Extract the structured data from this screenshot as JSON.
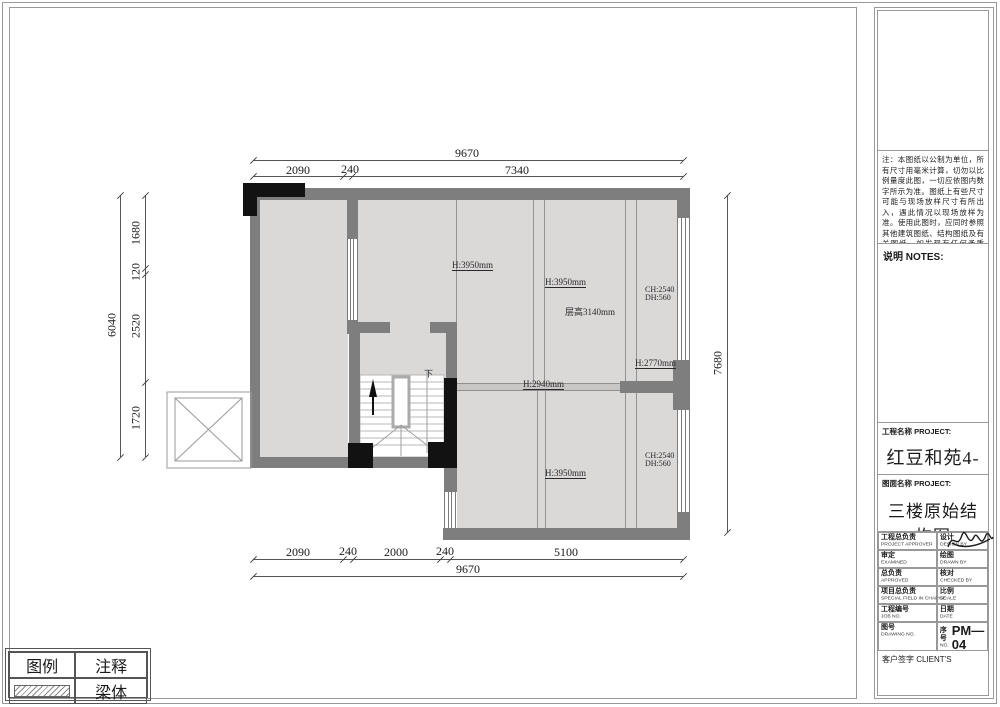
{
  "dims": {
    "top": {
      "total": "9670",
      "segs": [
        "2090",
        "240",
        "7340"
      ]
    },
    "bottom": {
      "total": "9670",
      "segs": [
        "2090",
        "240",
        "2000",
        "240",
        "5100"
      ]
    },
    "left": {
      "total": "6040",
      "segs": [
        "1680",
        "120",
        "2520",
        "1720"
      ]
    },
    "right": {
      "total": "7680"
    }
  },
  "plan_labels": {
    "h_a": "H:3950mm",
    "h_b": "H:3950mm",
    "storey": "层高3140mm",
    "ch_top": "CH:2540",
    "dh_top": "DH:560",
    "h_c": "H:2770mm",
    "h_d": "H:2940mm",
    "h_e": "H:3950mm",
    "ch_bot": "CH:2540",
    "dh_bot": "DH:560",
    "stair_down": "下"
  },
  "legend": {
    "title": "图例",
    "note_col": "注释",
    "beam_row": "梁体"
  },
  "titleblock": {
    "notes_text": "注：本图纸以公制为单位，所有尺寸用毫米计算，切勿以比例量度此图，一切应依图内数字所示为准。图纸上有些尺寸可能与现场放样尺寸有所出入，遇此情况以现场放样为准。使用此图时，应同时参照其他建筑图纸、结构图纸及有关图纸，如发现有任何矛盾处，应立即通知设计单位。",
    "notes_copyright": "此图版权为设计单位所有。",
    "notes_header": "说明  NOTES:",
    "project_label": "工程名称 PROJECT:",
    "project_name": "红豆和苑4-305",
    "drawing_label": "图面名称 PROJECT:",
    "drawing_name": "三楼原始结构图",
    "rows": [
      {
        "zh": "工程总负责",
        "en": "PROJECT APPROVER",
        "zh2": "设计",
        "en2": "DESIGN BY"
      },
      {
        "zh": "审定",
        "en": "EXAMINED",
        "zh2": "绘图",
        "en2": "DRAWN BY"
      },
      {
        "zh": "总负责",
        "en": "APPROVED",
        "zh2": "核对",
        "en2": "CHECKED BY"
      },
      {
        "zh": "项目总负责",
        "en": "SPECIAL FIELD IN CHARGE",
        "zh2": "比例",
        "en2": "SCALE"
      },
      {
        "zh": "工程编号",
        "en": "JOB NO.",
        "zh2": "日期",
        "en2": "DATE"
      },
      {
        "zh": "图号",
        "en": "DRAWING NO.",
        "zh2": "序号",
        "en2": "NO."
      }
    ],
    "serial_value": "PM—04",
    "client_sign": "客户签字 CLIENT'S"
  },
  "colors": {
    "wall": "#7e7e7e",
    "floor": "#dbd8d8",
    "column_black": "#121212",
    "line": "#555555"
  }
}
